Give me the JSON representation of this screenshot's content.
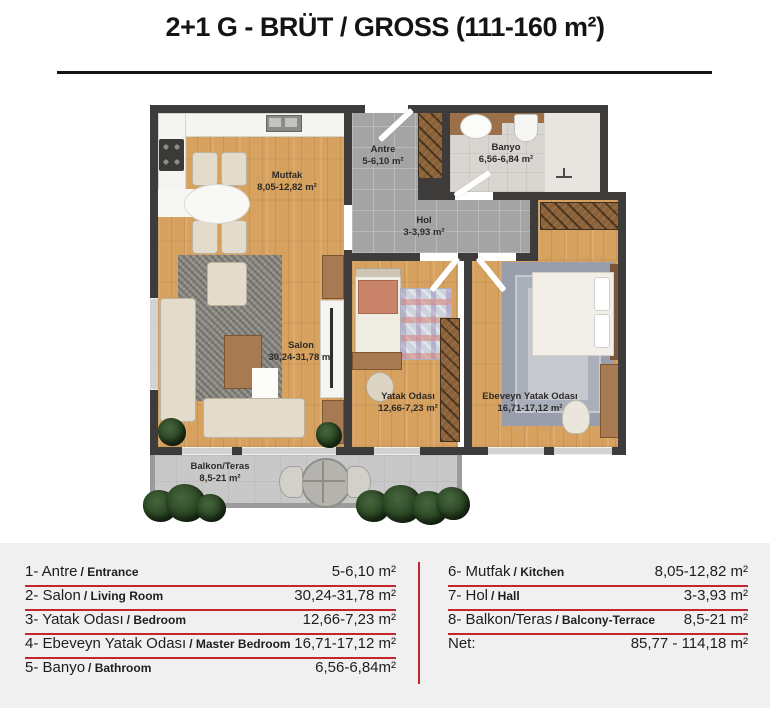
{
  "title": "2+1 G - BRÜT / GROSS (111-160 m²)",
  "plan": {
    "rooms": {
      "mutfak": {
        "name": "Mutfak",
        "area": "8,05-12,82 m²"
      },
      "antre": {
        "name": "Antre",
        "area": "5-6,10 m²"
      },
      "banyo": {
        "name": "Banyo",
        "area": "6,56-6,84 m²"
      },
      "hol": {
        "name": "Hol",
        "area": "3-3,93 m²"
      },
      "salon": {
        "name": "Salon",
        "area": "30,24-31,78 m²"
      },
      "yatak": {
        "name": "Yatak Odası",
        "area": "12,66-7,23 m²"
      },
      "ebeveyn": {
        "name": "Ebeveyn Yatak Odası",
        "area": "16,71-17,12 m²"
      },
      "balkon": {
        "name": "Balkon/Teras",
        "area": "8,5-21 m²"
      }
    }
  },
  "legend": {
    "left": [
      {
        "label": "1- Antre",
        "sub": "/ Entrance",
        "area": "5-6,10 m²"
      },
      {
        "label": "2- Salon",
        "sub": "/ Living Room",
        "area": "30,24-31,78 m²"
      },
      {
        "label": "3- Yatak Odası",
        "sub": "/ Bedroom",
        "area": "12,66-7,23 m²"
      },
      {
        "label": "4- Ebeveyn Yatak Odası",
        "sub": "/ Master Bedroom",
        "area": "16,71-17,12 m²"
      },
      {
        "label": "5- Banyo",
        "sub": "/ Bathroom",
        "area": "6,56-6,84m²"
      }
    ],
    "right": [
      {
        "label": "6- Mutfak",
        "sub": "/ Kitchen",
        "area": "8,05-12,82 m²"
      },
      {
        "label": "7- Hol",
        "sub": "/ Hall",
        "area": "3-3,93 m²"
      },
      {
        "label": "8- Balkon/Teras",
        "sub": "/ Balcony-Terrace",
        "area": "8,5-21 m²"
      }
    ],
    "net_label": "Net:",
    "net_value": "85,77 - 114,18 m²"
  },
  "colors": {
    "accent_red": "#c2272d",
    "wall": "#3e3c3b",
    "wood_floor": "#d7a25f",
    "tile_gray": "#a4a4a4",
    "legend_background": "#f0f0f0"
  }
}
